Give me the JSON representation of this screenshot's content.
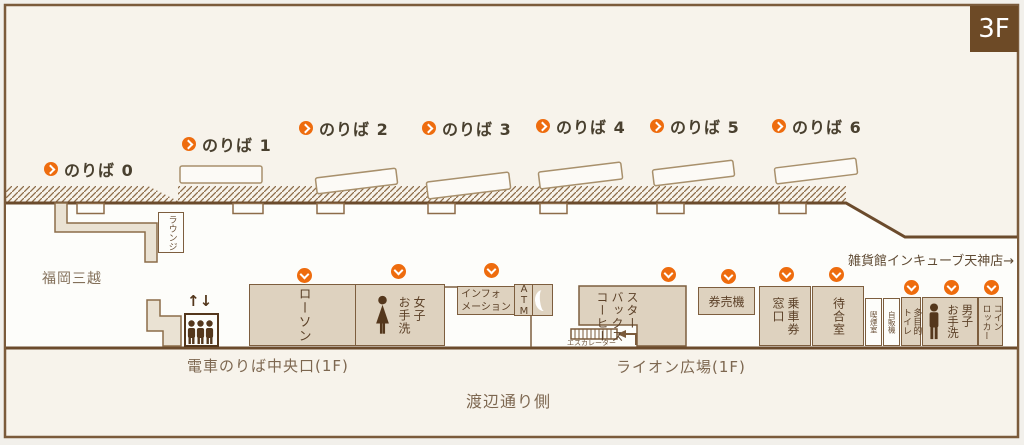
{
  "floor": {
    "badge": "3F"
  },
  "platforms": [
    {
      "label": "のりば 0"
    },
    {
      "label": "のりば 1"
    },
    {
      "label": "のりば 2"
    },
    {
      "label": "のりば 3"
    },
    {
      "label": "のりば 4"
    },
    {
      "label": "のりば 5"
    },
    {
      "label": "のりば 6"
    }
  ],
  "facilities": {
    "lawson": {
      "label": "ローソン"
    },
    "womens_restroom": {
      "label": "女子\nお手洗"
    },
    "information": {
      "label": "インフォ\nメーション"
    },
    "atm": {
      "label": "ATM"
    },
    "starbucks": {
      "label": "スター\nバックス\nコーヒー"
    },
    "ticket_machine": {
      "label": "券売機"
    },
    "ticket_window": {
      "label": "乗車券\n窓口"
    },
    "waiting_room": {
      "label": "待合室"
    },
    "smoking_room": {
      "label": "喫煙室"
    },
    "vending_machine": {
      "label": "自販機"
    },
    "multipurpose_toilet": {
      "label": "多目的\nトイレ"
    },
    "mens_restroom": {
      "label": "男子\nお手洗"
    },
    "coin_locker": {
      "label": "コイン\nロッカー"
    },
    "lounge": {
      "label": "ラウンジ"
    },
    "escalator": {
      "label": "エスカレーター"
    },
    "elevator": {
      "arrows": "↑↓"
    }
  },
  "areas": {
    "mitsukoshi": "福岡三越",
    "train_boarding_central_gate": "電車のりば中央口(1F)",
    "lion_plaza": "ライオン広場(1F)",
    "watanabe_street_side": "渡辺通り側",
    "incube_store": "雑貨館インキューブ天神店→"
  },
  "colors": {
    "accent_orange": "#ee6c0e",
    "wall_brown": "#6b4b2c",
    "badge_brown": "#6d4a26",
    "facility_tan": "#ded2bf",
    "floor_beige": "#f7f3eb"
  }
}
